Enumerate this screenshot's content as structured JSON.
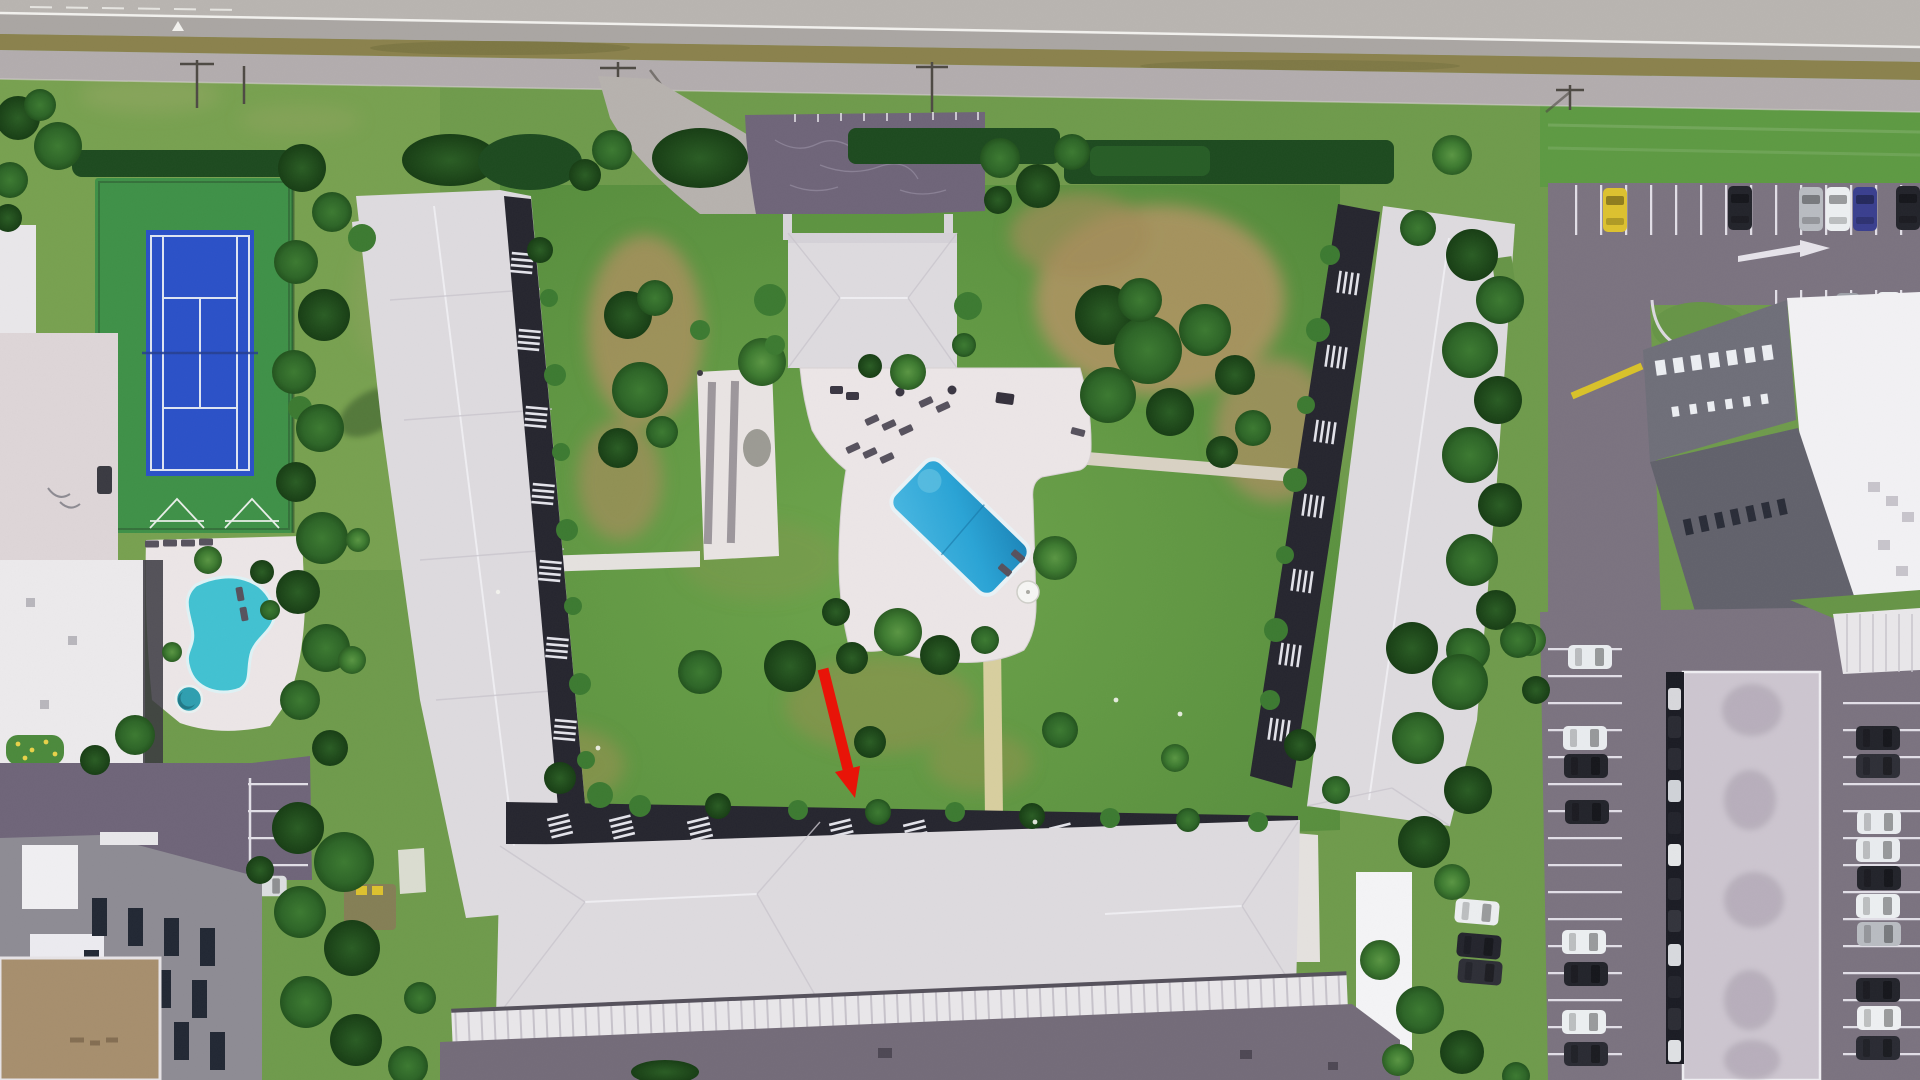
{
  "meta": {
    "domain": "Natural-Image",
    "description": "Aerial drone photograph of an oceanfront condominium complex: a U-shaped three-wing building with sawtooth balcony edges around a grass courtyard containing a clubhouse, white pool deck and tilted rectangular swimming pool. Neighboring property at left has a tennis court, shuffleboard courts and kidney-shaped pool. Highway and frontage road run along the top. Parking lots with parked cars at right and bottom. A red arrow annotation points down toward the south wing courtyard edge.",
    "image_width": 1920,
    "image_height": 1080
  },
  "colors": {
    "arrow-red": "#e81408",
    "pool-blue": "#2aa4d6",
    "kidney-pool-teal": "#42c2d2",
    "tennis-court-blue": "#2b51c8",
    "tennis-surround-green": "#3f9148",
    "lawn-green": "#6f9b4c",
    "hedge-green": "#1d4a1f",
    "tree-green": "#2f6b2a",
    "roof-white": "#dedbdf",
    "sawtooth-dark": "#26262f",
    "asphalt-purple": "#6f6579",
    "asphalt-gray": "#7b7380",
    "deck-white": "#ece6e7",
    "path-tan": "#d8cf9f",
    "road-gray": "#b9b5b1",
    "median-olive": "#8b824d"
  },
  "scene": {
    "type": "aerial-photo",
    "annotation_arrow": {
      "color_key": "arrow-red",
      "tail_x": "823",
      "tail_y": "669",
      "shaft_end_x": "848",
      "shaft_end_y": "769",
      "head_points": "855,798 860,766 835,772",
      "points_at": "courtyard lawn at north edge of south wing"
    },
    "features": [
      {
        "id": "highway",
        "label": "highway with white edge line"
      },
      {
        "id": "frontage-road",
        "label": "frontage road"
      },
      {
        "id": "median-strip",
        "label": "scrub median strip"
      },
      {
        "id": "tennis-court",
        "label": "tennis court with blue playing surface"
      },
      {
        "id": "shuffleboard-courts",
        "label": "shuffleboard courts"
      },
      {
        "id": "kidney-pool",
        "label": "kidney-shaped pool with round spa"
      },
      {
        "id": "left-neighbor-buildings",
        "label": "neighboring buildings at left"
      },
      {
        "id": "clubhouse",
        "label": "clubhouse with hip roof"
      },
      {
        "id": "clubhouse-parking",
        "label": "cracked asphalt parking lot"
      },
      {
        "id": "pool-deck",
        "label": "white pool deck with lounge chairs and umbrella"
      },
      {
        "id": "swimming-pool",
        "label": "tilted rectangular swimming pool"
      },
      {
        "id": "west-wing",
        "label": "west condo wing with sawtooth balconies"
      },
      {
        "id": "south-wing",
        "label": "south condo wing with sawtooth balconies"
      },
      {
        "id": "east-wing",
        "label": "east condo wing with sawtooth balconies"
      },
      {
        "id": "garage-row",
        "label": "row of garages south of complex"
      },
      {
        "id": "courtyard-lawn",
        "label": "courtyard lawn with dry brown patches"
      },
      {
        "id": "far-right-building",
        "label": "tall gray building at far right"
      },
      {
        "id": "right-parking",
        "label": "parking lots with parked cars"
      },
      {
        "id": "hedges",
        "label": "trimmed hedge rows"
      },
      {
        "id": "annotation-arrow",
        "label": "red annotation arrow"
      }
    ]
  }
}
